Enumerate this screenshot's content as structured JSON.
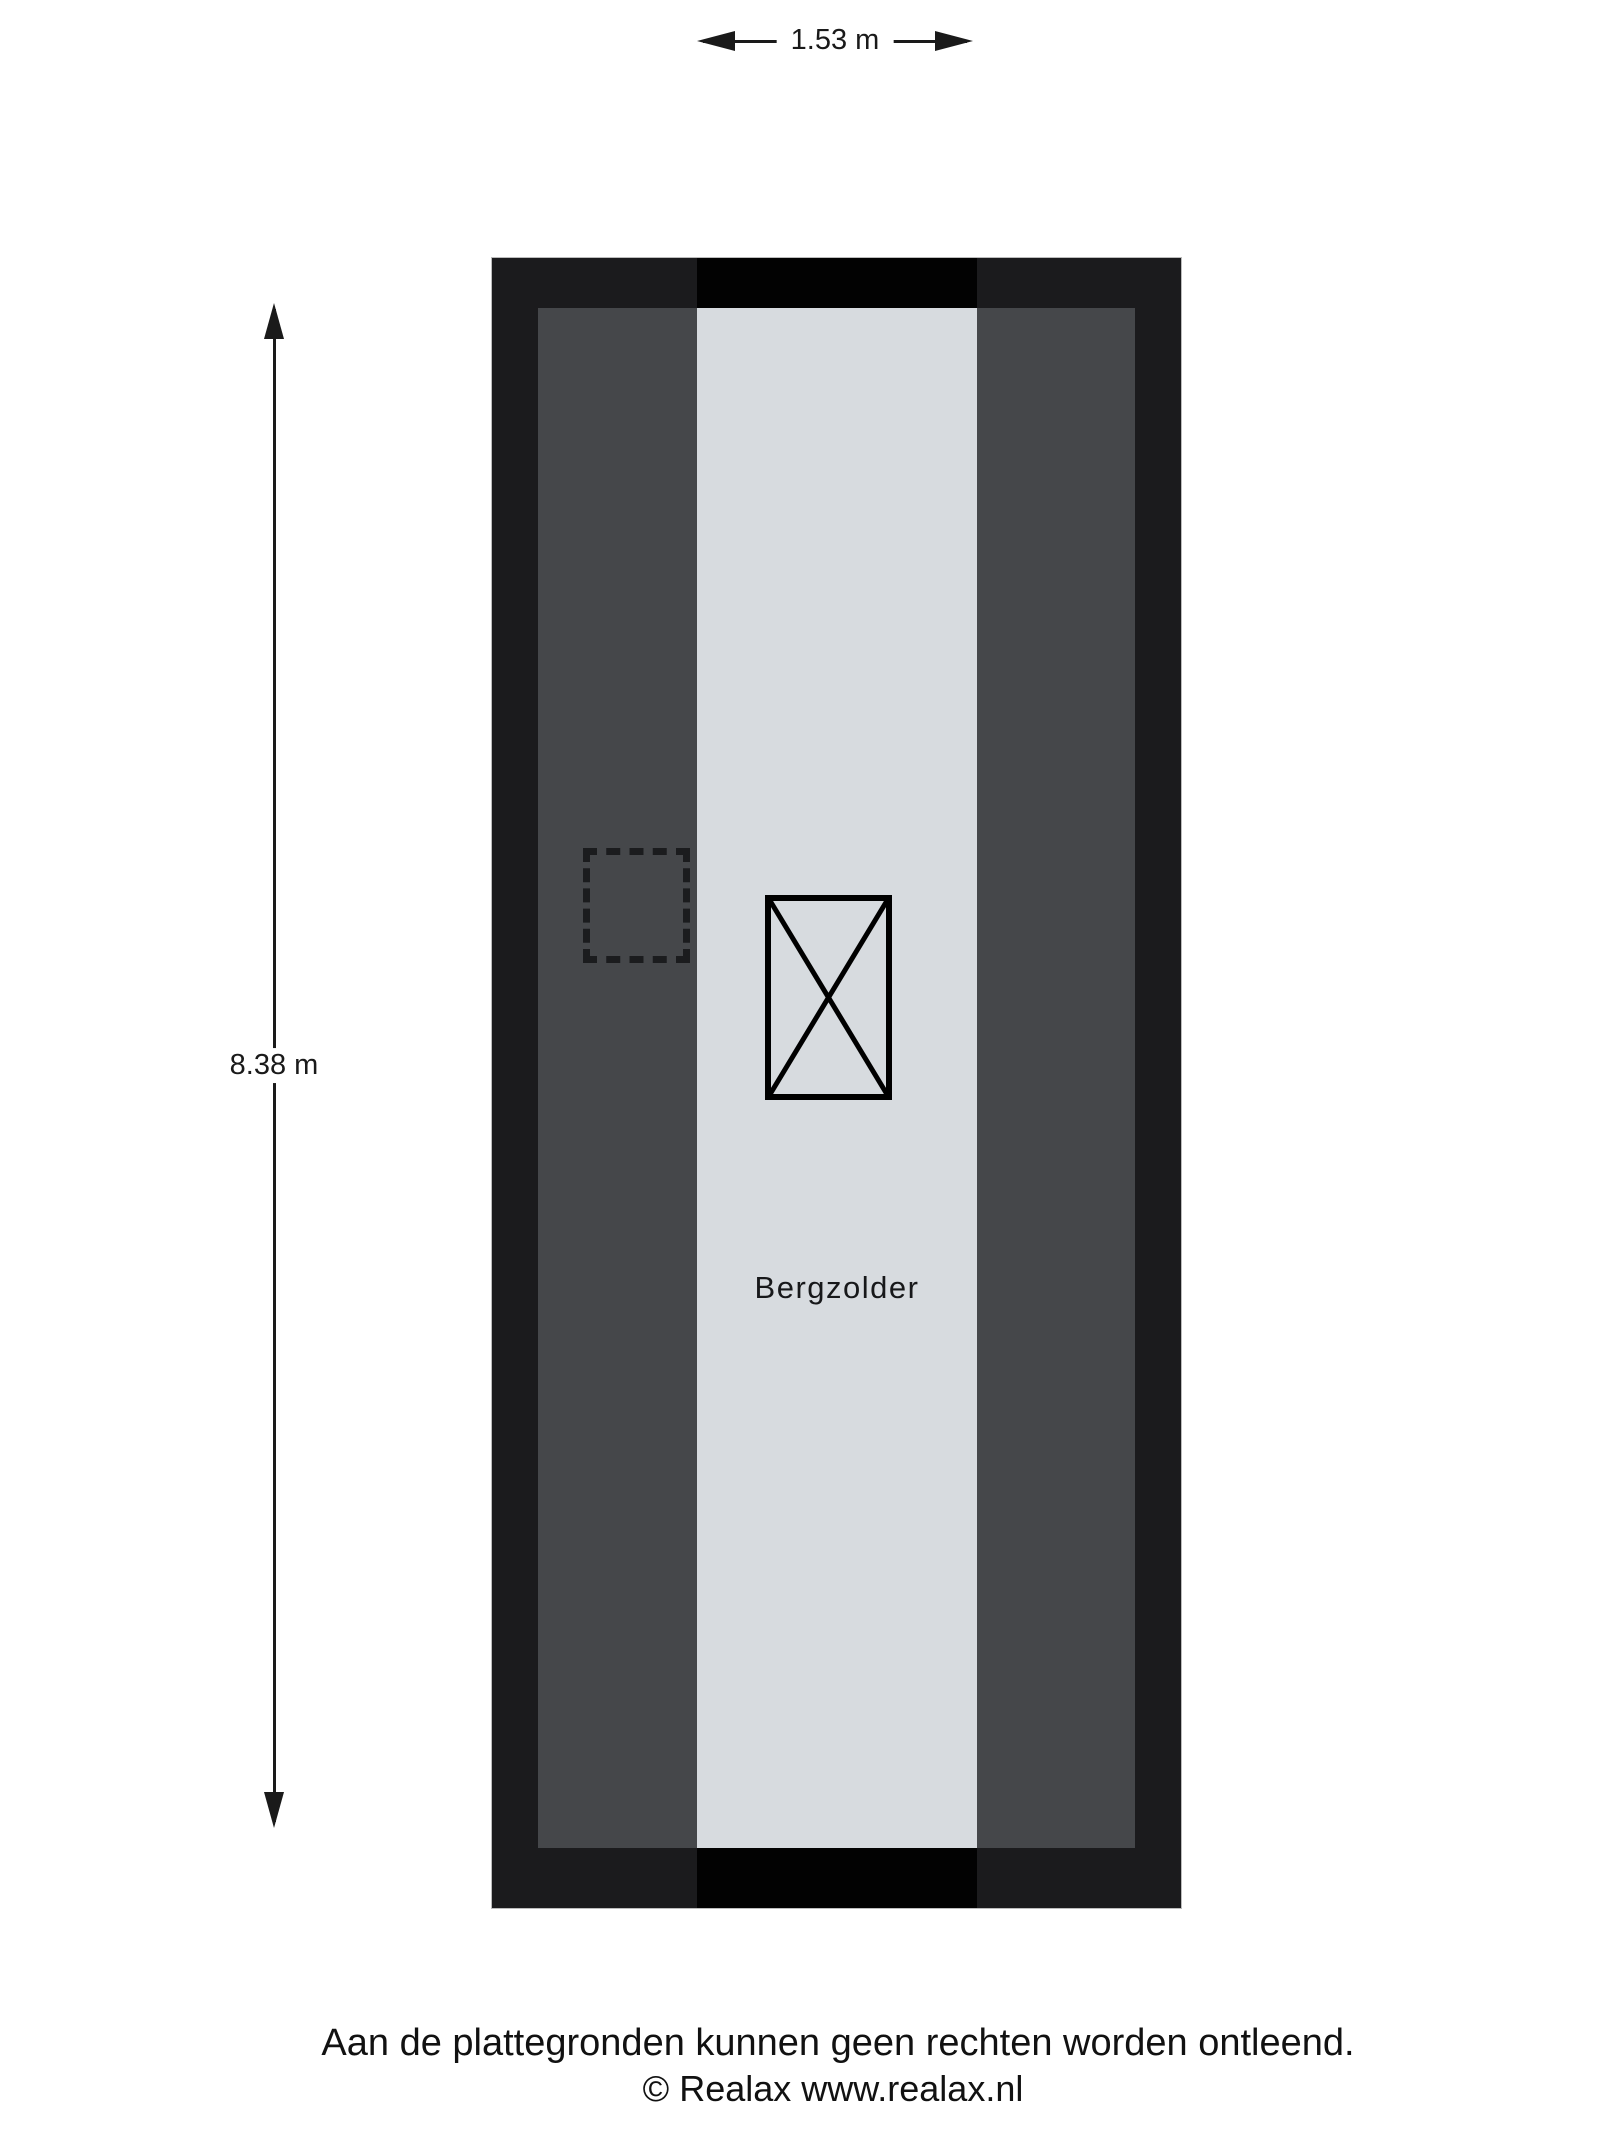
{
  "title": "Floor plan Bergzolder",
  "colors": {
    "paper": "#ffffff",
    "ink": "#1a1a1a",
    "wall": "#1b1b1d",
    "slope": "#45474a",
    "floor": "#d7dbdf",
    "void": "#020202",
    "dash": "#1b1c1e"
  },
  "dimensions": {
    "width_label": "1.53 m",
    "height_label": "8.38 m"
  },
  "floorplan": {
    "room_label": "Bergzolder"
  },
  "footer": {
    "disclaimer": "Aan de plattegronden kunnen geen rechten worden ontleend.",
    "copyright": "© Realax www.realax.nl"
  }
}
